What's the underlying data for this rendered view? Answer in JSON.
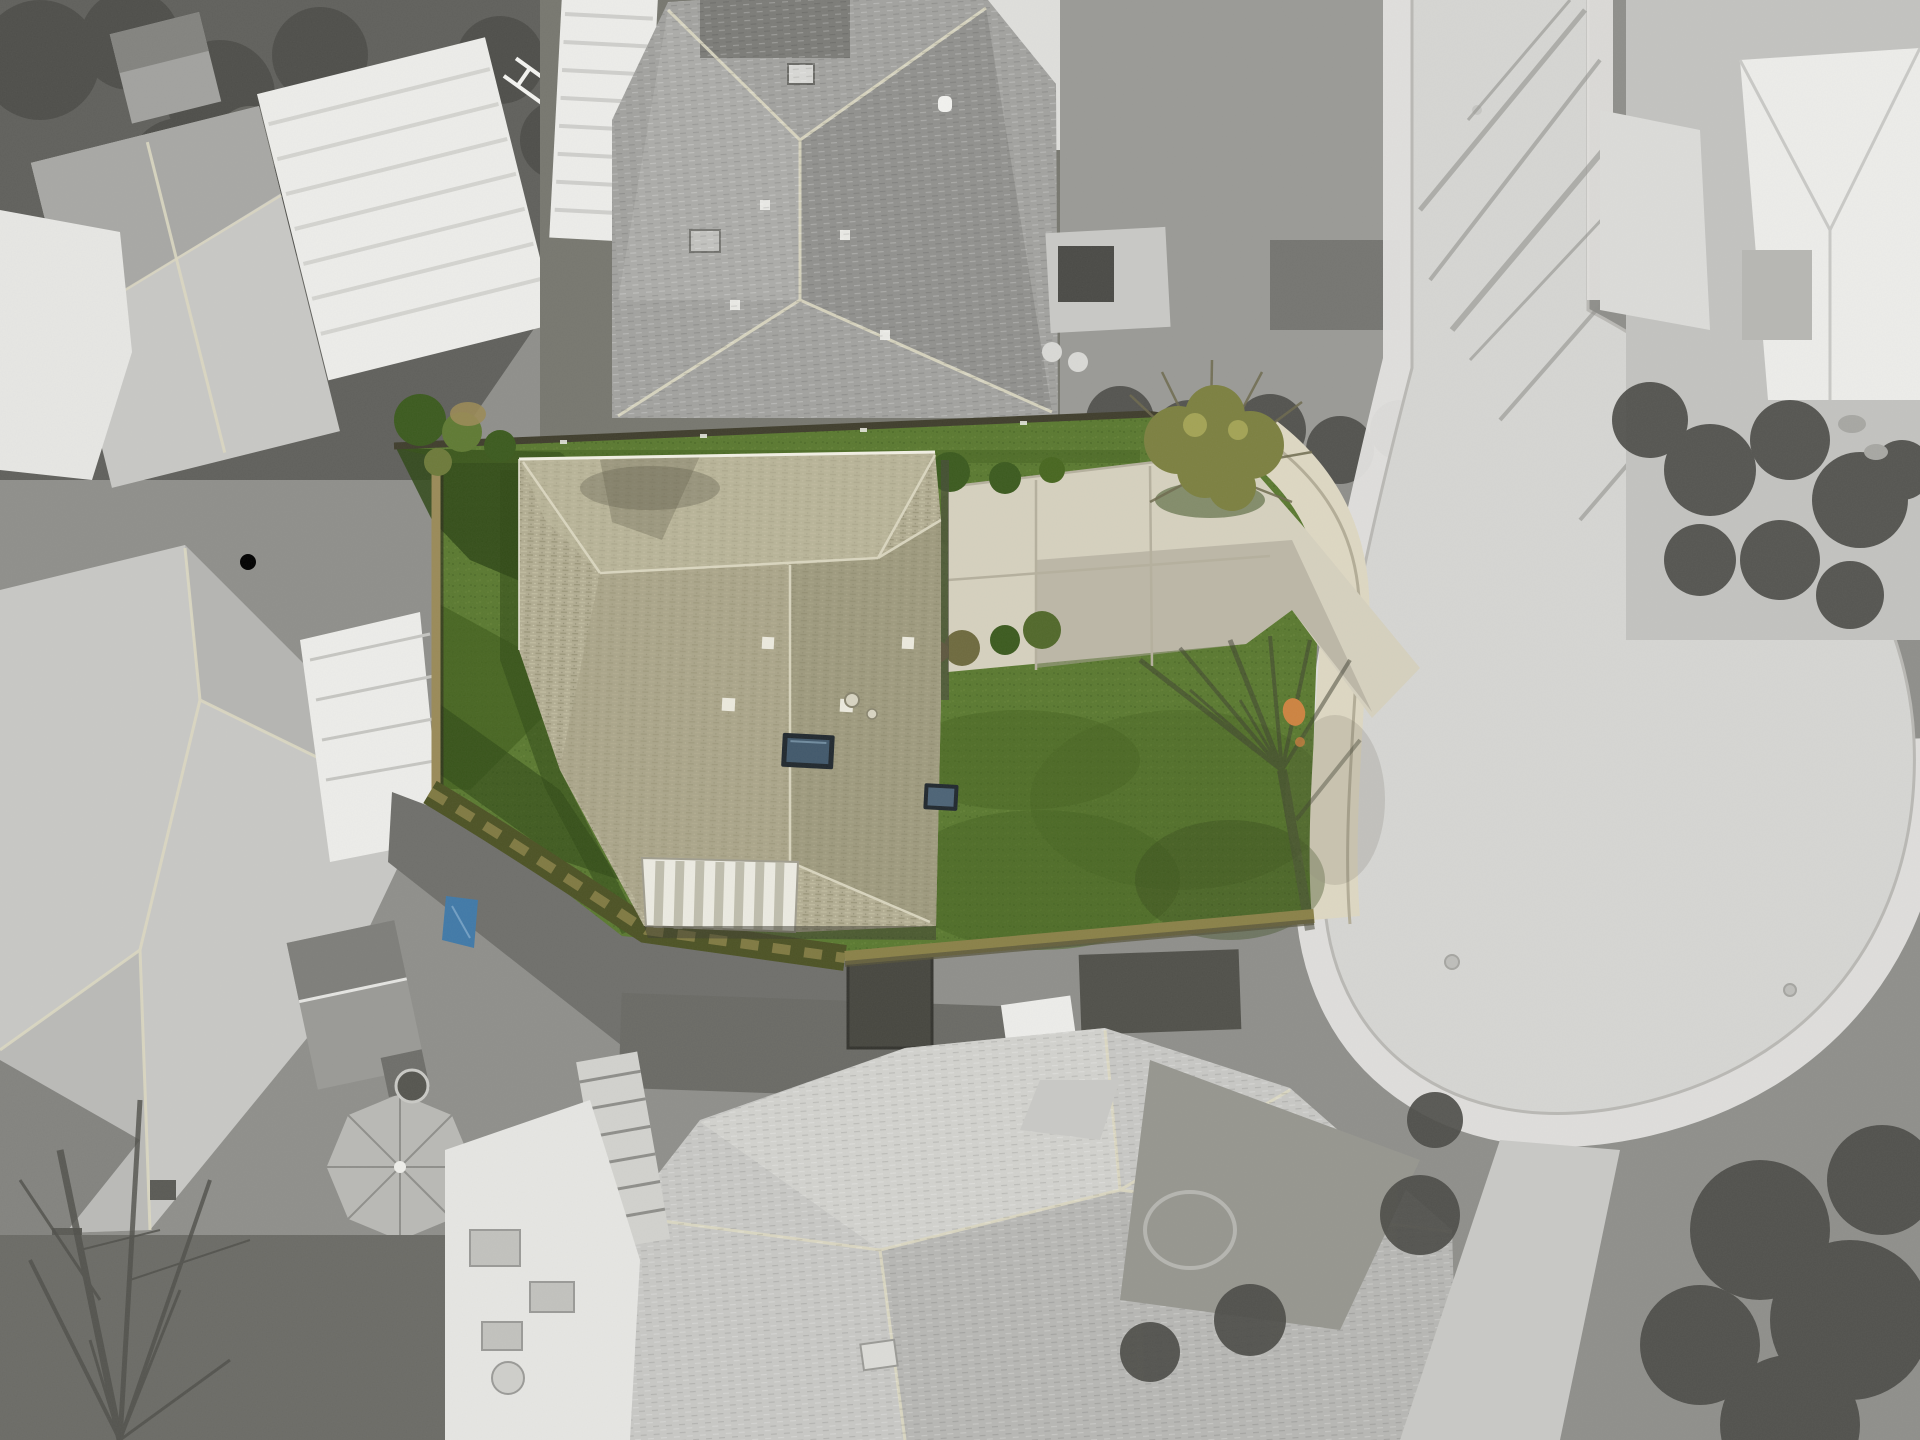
{
  "meta": {
    "title": "Aerial drone photograph of a suburban cul-de-sac; the subject property is shown in color while all surrounding properties and streets are desaturated to grayscale",
    "alt": "Top-down aerial photo. A tan hip-roofed house with green front and back lawns, a concrete driveway and a white striped sunroom awning is highlighted in full color. Everything around it — neighboring houses, decks, sheds, trees, and the cul-de-sac street wrapping the lot on the right — is black-and-white.",
    "width_px": 1920,
    "height_px": 1440
  },
  "palette": {
    "road": "#d6d6d3",
    "road_edge": "#b9b8b4",
    "sidewalk_gray": "#e4e3e0",
    "sidewalk_warm": "#ded8c3",
    "concrete_warm": "#d6d1bf",
    "concrete_warm_shade": "#a8a394",
    "pavement_dark": "#6f6f6b",
    "pavement_mid": "#8f8f8b",
    "pavement_pale": "#c9c9c6",
    "yard_dark": "#60605c",
    "canopy_dark": "#4c4c48",
    "roof_light": "#c8c8c5",
    "roof_mid": "#a2a29f",
    "roof_dark": "#83837f",
    "white_struct": "#ededea",
    "roof_tan": "#b2ad92",
    "roof_tan_lit": "#bdb89c",
    "roof_tan_mid": "#a49f82",
    "roof_tan_dark": "#908c6f",
    "ridge_pale": "#dcd8c2",
    "lawn": "#5a7930",
    "lawn_dark": "#44611f",
    "lawn_shadow": "#2f4816",
    "hedge": "#4c5224",
    "moss": "#8a8148",
    "shrub_dark": "#3b5a1e",
    "shrub_olive": "#7c8040",
    "shrub_yellow": "#a3a355",
    "skylight": "#41586b",
    "skylight_rim": "#20282e",
    "fence_wood": "#9a8a58",
    "fence_dark": "#3f3d2c",
    "tarp_blue": "#4079a8",
    "orange": "#cd8340",
    "vent_white": "#eceade"
  },
  "scene": {
    "highlight_style": "color-on-grayscale real-estate aerial",
    "subject_property": {
      "label": "subject lot, highlighted in color",
      "house": {
        "roof": "tan/khaki asphalt-shingle hip roof",
        "skylights": 2,
        "roof_vents": 4,
        "awning": "white ribbed sunroom awning on lower-left wing"
      },
      "yard": {
        "back_lawn": "green lawn with tree shadows, left of house",
        "front_lawn": "curved green lawn facing cul-de-sac",
        "hedge": "olive laurel hedge along lower boundary",
        "moss_wall": "mossy retaining wall along street frontage",
        "fences": [
          "dark rear fence along top",
          "tan wood fence on left side"
        ],
        "shrubs": [
          "corner shrub bed top-left",
          "olive corner tree top-right",
          "foundation shrubs by driveway"
        ]
      },
      "driveway": "warm concrete driveway with expansion joints and cast tree shadow",
      "accents": [
        "orange marker on front walk",
        "blue tarp near lower-left corner"
      ]
    },
    "street": {
      "label": "cul-de-sac",
      "parts": [
        "straight road entering from top right",
        "turnaround bulb at right",
        "pale sidewalk ring",
        "manhole covers",
        "bare-tree shadows across pavement"
      ]
    },
    "neighbors": [
      "top-left house with bright white deck and ladder",
      "large gray hip-roof house top-center with RV pad",
      "white house right of road at top",
      "left house with white deck and gazebo",
      "shed and bare winter tree bottom-left",
      "large light-gray hip-roof house bottom-center with patio furniture",
      "hedge and tree rows along lower-right of the bulb"
    ]
  }
}
